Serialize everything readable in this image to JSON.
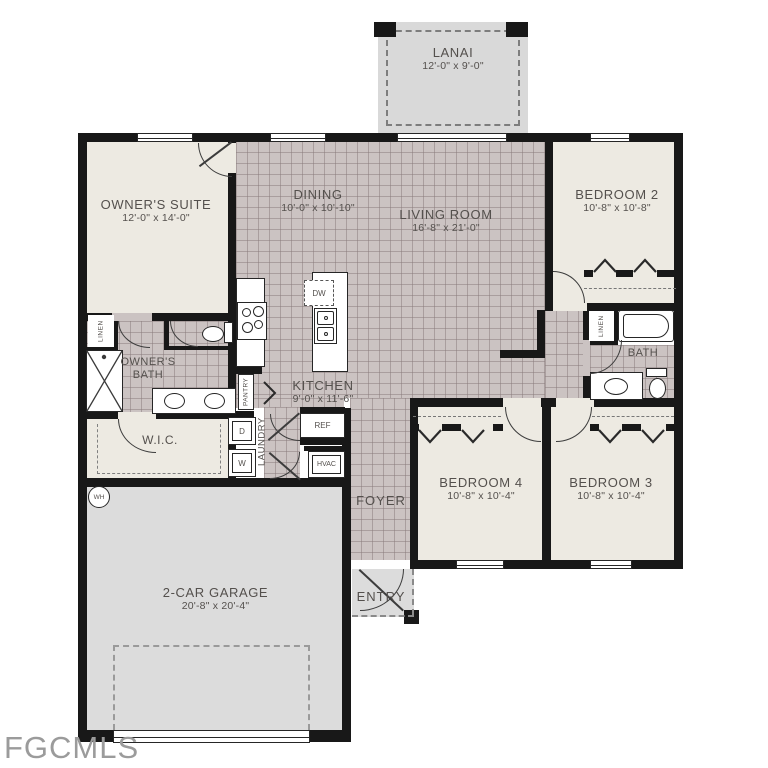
{
  "watermark": {
    "text": "FGCMLS"
  },
  "colors": {
    "wall": "#181818",
    "tile_floor": "#cbc3c2",
    "carpet_floor": "#edeae2",
    "garage_floor": "#dcdcdc",
    "label_text": "#54504d",
    "watermark_text": "#9b9b9b"
  },
  "rooms": {
    "lanai": {
      "name": "LANAI",
      "dims": "12'-0\" x 9'-0\""
    },
    "owners_suite": {
      "name": "OWNER'S SUITE",
      "dims": "12'-0\" x 14'-0\""
    },
    "dining": {
      "name": "DINING",
      "dims": "10'-0\" x 10'-10\""
    },
    "living_room": {
      "name": "LIVING ROOM",
      "dims": "16'-8\" x 21'-0\""
    },
    "bedroom2": {
      "name": "BEDROOM 2",
      "dims": "10'-8\" x 10'-8\""
    },
    "bedroom3": {
      "name": "BEDROOM 3",
      "dims": "10'-8\" x 10'-4\""
    },
    "bedroom4": {
      "name": "BEDROOM 4",
      "dims": "10'-8\" x 10'-4\""
    },
    "kitchen": {
      "name": "KITCHEN",
      "dims": "9'-0\" x 11'-6\""
    },
    "garage": {
      "name": "2-CAR GARAGE",
      "dims": "20'-8\" x 20'-4\""
    },
    "owners_bath": {
      "name": "OWNER'S BATH"
    },
    "bath": {
      "name": "BATH"
    },
    "wic": {
      "name": "W.I.C."
    },
    "foyer": {
      "name": "FOYER"
    },
    "entry": {
      "name": "ENTRY"
    },
    "pantry": {
      "name": "PANTRY"
    },
    "laundry": {
      "name": "LAUNDRY"
    },
    "linen": {
      "name": "LINEN"
    }
  },
  "appliances": {
    "dishwasher": "DW",
    "refrigerator": "REF",
    "hvac": "HVAC",
    "dryer": "D",
    "washer": "W",
    "water_heater": "WH"
  }
}
